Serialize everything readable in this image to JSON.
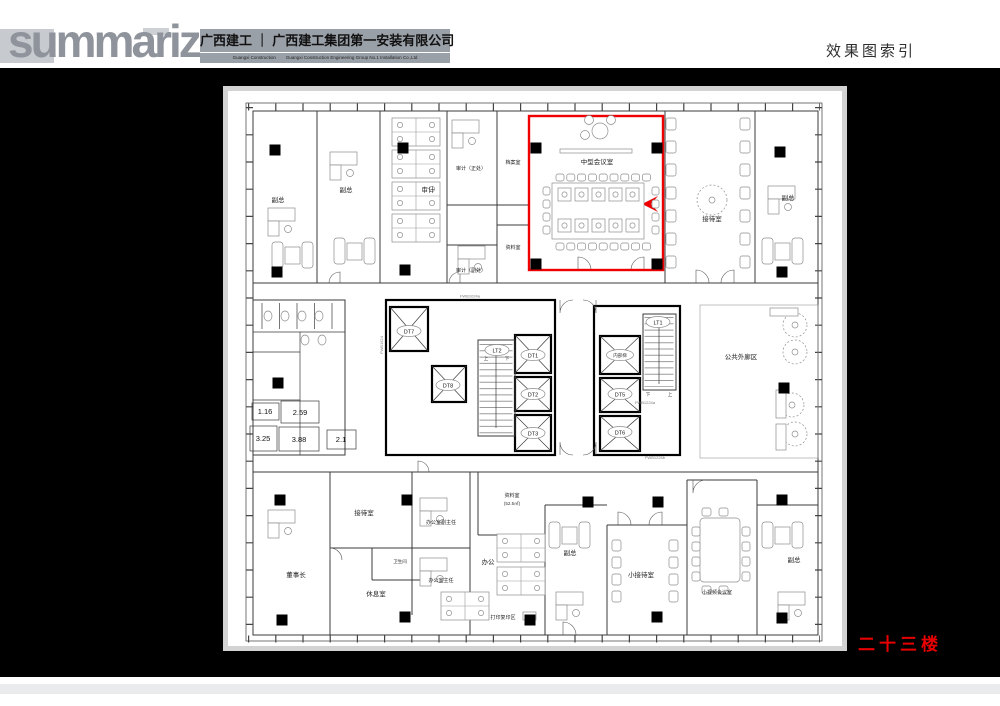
{
  "header": {
    "logo": "summarize",
    "company_cn": "广西建工 ｜ 广西建工集团第一安装有限公司",
    "company_en": "Guangxi Construction        Guangxi Construction Engineering Group No.1 Installation Co.,Ltd",
    "page_title": "效果图索引"
  },
  "floor_label": "二十三楼",
  "colors": {
    "accent_red": "#e80000",
    "logo_gray": "#8f949c",
    "band_gray": "#9aa0a8",
    "canvas_black": "#000000",
    "sheet_border": "#d3d3d3"
  },
  "plan": {
    "rooms": {
      "vp1": {
        "label": "副总"
      },
      "vp2": {
        "label": "副总"
      },
      "audit_open": {
        "label": "审计"
      },
      "audit_chief": {
        "label": "审计（正处）"
      },
      "archive": {
        "label": "档案室"
      },
      "audit_deputy": {
        "label": "审计（副处）"
      },
      "data_top": {
        "label": "资料室"
      },
      "conference": {
        "label": "中型会议室"
      },
      "reception_top": {
        "label": "接待室"
      },
      "vp3": {
        "label": "副总"
      },
      "corridor": {
        "label": "公共外廊区"
      },
      "chairman": {
        "label": "董事长"
      },
      "reception_btm": {
        "label": "接待室"
      },
      "lounge": {
        "label": "休息室"
      },
      "wc": {
        "label": "卫生间"
      },
      "office_deputy": {
        "label": "办公室副主任"
      },
      "office_director": {
        "label": "办公室主任"
      },
      "open_office": {
        "label": "办公"
      },
      "data_btm": {
        "label": "资料室",
        "area": "(52.5㎡)"
      },
      "print": {
        "label": "打印复印区"
      },
      "vp4": {
        "label": "副总"
      },
      "small_reception": {
        "label": "小接待室"
      },
      "video_conf": {
        "label": "小视频会议室"
      },
      "vp5": {
        "label": "副总"
      }
    },
    "elevators": {
      "dt1": "DT1",
      "dt2": "DT2",
      "dt3": "DT3",
      "dt5": "DT5",
      "dt6": "DT6",
      "dt7": "DT7",
      "dt8": "DT8"
    },
    "stairs": {
      "lt1": "LT1",
      "lt2": "LT2",
      "internal": "内部梯",
      "up": "上",
      "down": "下"
    },
    "area_numbers": [
      "1.16",
      "2.59",
      "3.25",
      "3.88",
      "2.1"
    ],
    "door_codes": [
      "FWB1524",
      "FWB1024a",
      "FWB1224a",
      "FWB1224b"
    ]
  }
}
